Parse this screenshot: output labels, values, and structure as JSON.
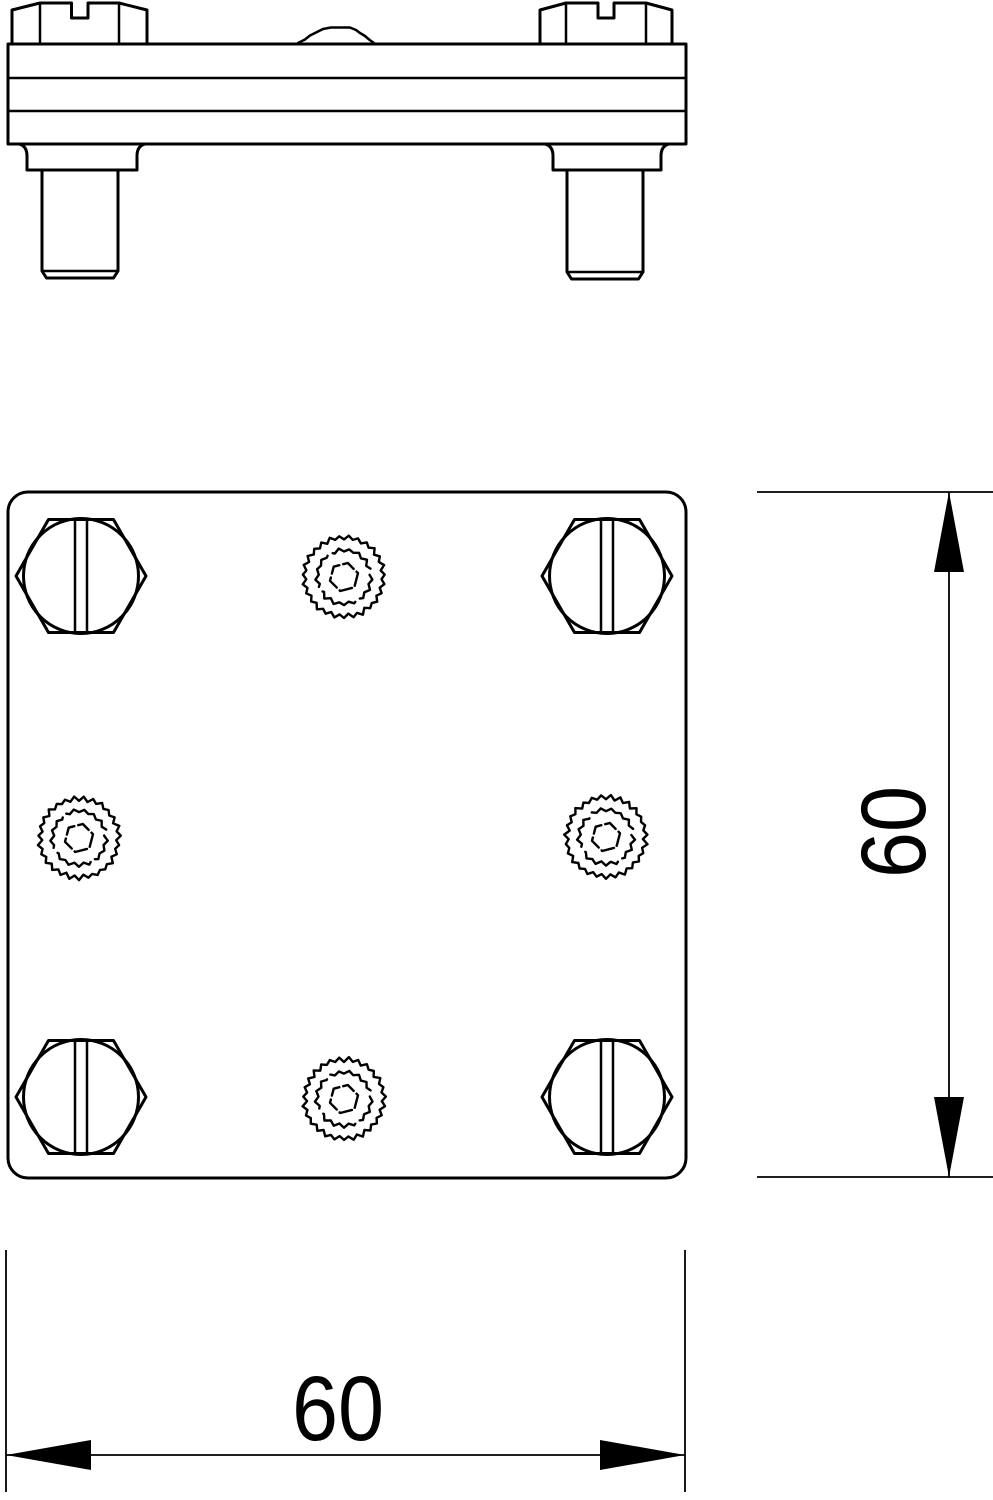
{
  "colors": {
    "line": "#000000",
    "background": "#ffffff"
  },
  "dimensions": {
    "height_label": "60",
    "width_label": "60"
  }
}
